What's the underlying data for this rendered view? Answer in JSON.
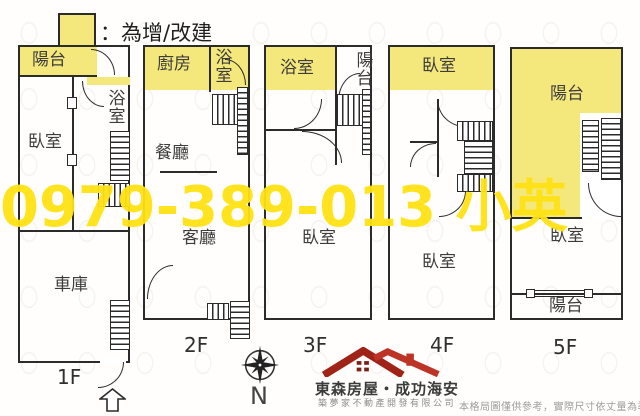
{
  "legend": {
    "label": "：為增/改建"
  },
  "watermark": {
    "text": "0979-389-013 小英"
  },
  "colors": {
    "highlight": "#F4E87C",
    "watermark": "#FFE214",
    "brand_red": "#A02318",
    "brand_red_light": "#BD3427",
    "wall": "#2b2b2b"
  },
  "floors": [
    {
      "label": "1F",
      "rooms": [
        "陽台",
        "浴室",
        "臥室",
        "車庫"
      ]
    },
    {
      "label": "2F",
      "rooms": [
        "廚房",
        "浴室",
        "餐廳",
        "客廳"
      ]
    },
    {
      "label": "3F",
      "rooms": [
        "浴室",
        "陽台",
        "臥室"
      ]
    },
    {
      "label": "4F",
      "rooms": [
        "臥室",
        "臥室"
      ]
    },
    {
      "label": "5F",
      "rooms": [
        "陽台",
        "臥室",
        "陽台"
      ]
    }
  ],
  "compass": {
    "label": "N"
  },
  "footer": {
    "brand": "東森房屋・成功海安",
    "company": "築夢家不動產開發有限公司",
    "disclaimer": "本格局圖僅供參考，實際尺寸依丈量為準"
  }
}
